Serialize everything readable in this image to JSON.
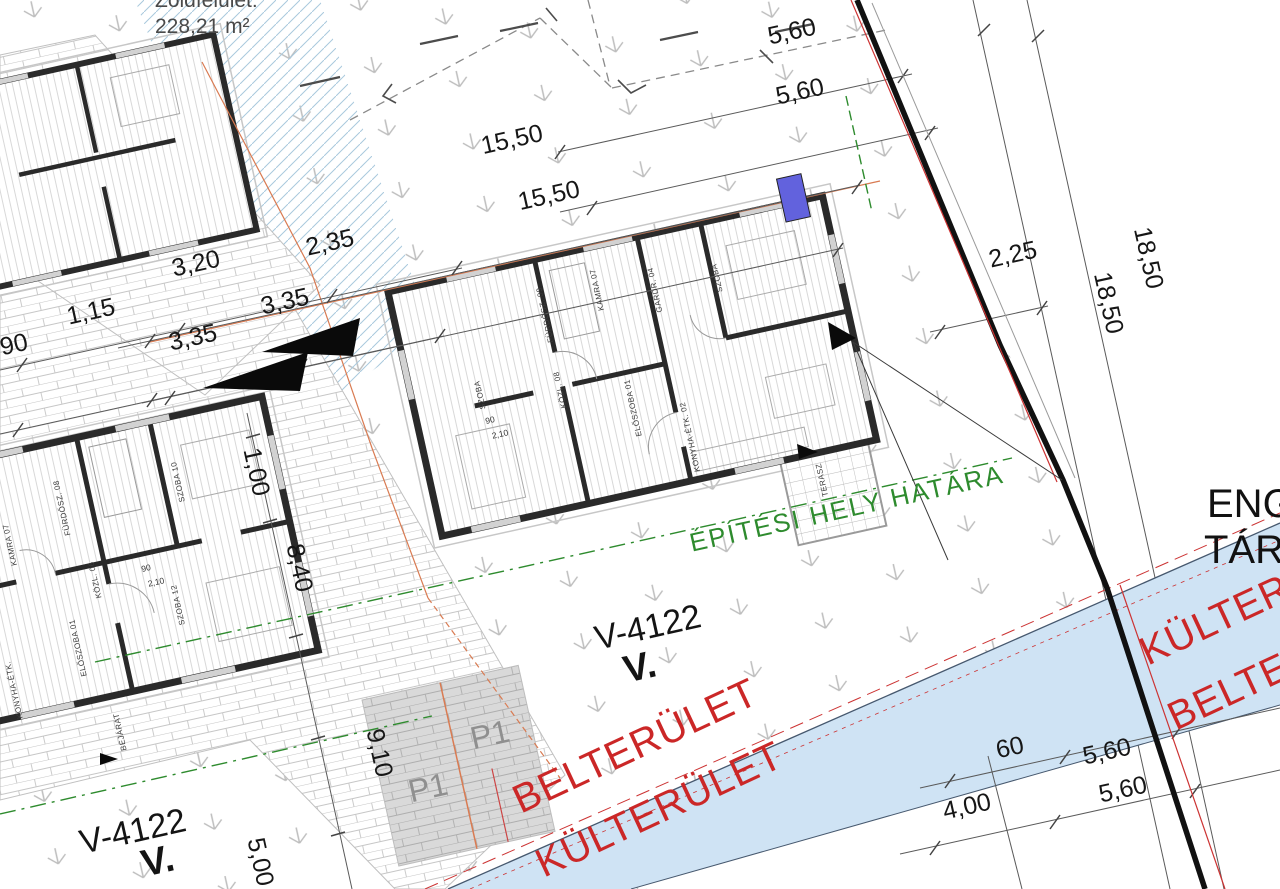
{
  "title_block": {
    "green_area_label": "Zöldfelület:",
    "green_area_value": "228,21 m²"
  },
  "dims": [
    "5,60",
    "5,60",
    "15,50",
    "15,50",
    "2,35",
    "3,20",
    "3,35",
    "3,35",
    "1,15",
    "90",
    "2,25",
    "18,50",
    "18,50",
    "1,00",
    "8,40",
    "9,10",
    "5,00",
    "60",
    "5,60",
    "4,00",
    "5,60"
  ],
  "parcels": {
    "center": {
      "code": "V-4122",
      "roman": "V."
    },
    "southwest": {
      "code": "V-4122",
      "roman": "V."
    }
  },
  "boundaries": {
    "building_site": "ÉPÍTÉSI HELY HATÁRA",
    "inner_area": "BELTERÜLET",
    "outer_area": "KÜLTERÜLET",
    "right_outer": "KÜLTERÜLET",
    "right_inner": "BELTERÜLET",
    "edge_text_line1": "ENG",
    "edge_text_line2": "TÁR"
  },
  "parking": {
    "stall1": "P1",
    "stall2": "P1"
  },
  "house_main": {
    "rooms": [
      "SZOBA",
      "FÜRDŐSZ. 09",
      "KAMRA 07",
      "GARDR. 04",
      "KÖZL. 08",
      "ELŐSZOBA 01",
      "KONYHA-ÉTK. 02",
      "SZOBA",
      "TERASZ"
    ]
  },
  "house_left": {
    "rooms": [
      "SZOBA 10",
      "FÜRDŐSZ. 08",
      "KAMRA 07",
      "KÖZL. 06",
      "SZOBA 12",
      "ELŐSZOBA 01",
      "KONYHA-ÉTK.",
      "BEJÁRAT"
    ]
  },
  "door_dims": {
    "width": "90",
    "height": "2,10"
  },
  "colors": {
    "boundary_black": "#111111",
    "boundary_red": "#cc3333",
    "site_green": "#2e8b2e",
    "area_red": "#cb2727",
    "water_blue": "#cfe3f4",
    "marker_blue": "#6262dd",
    "paving_gray": "#d9d9d9",
    "hatch_blue": "#aacbe0"
  }
}
